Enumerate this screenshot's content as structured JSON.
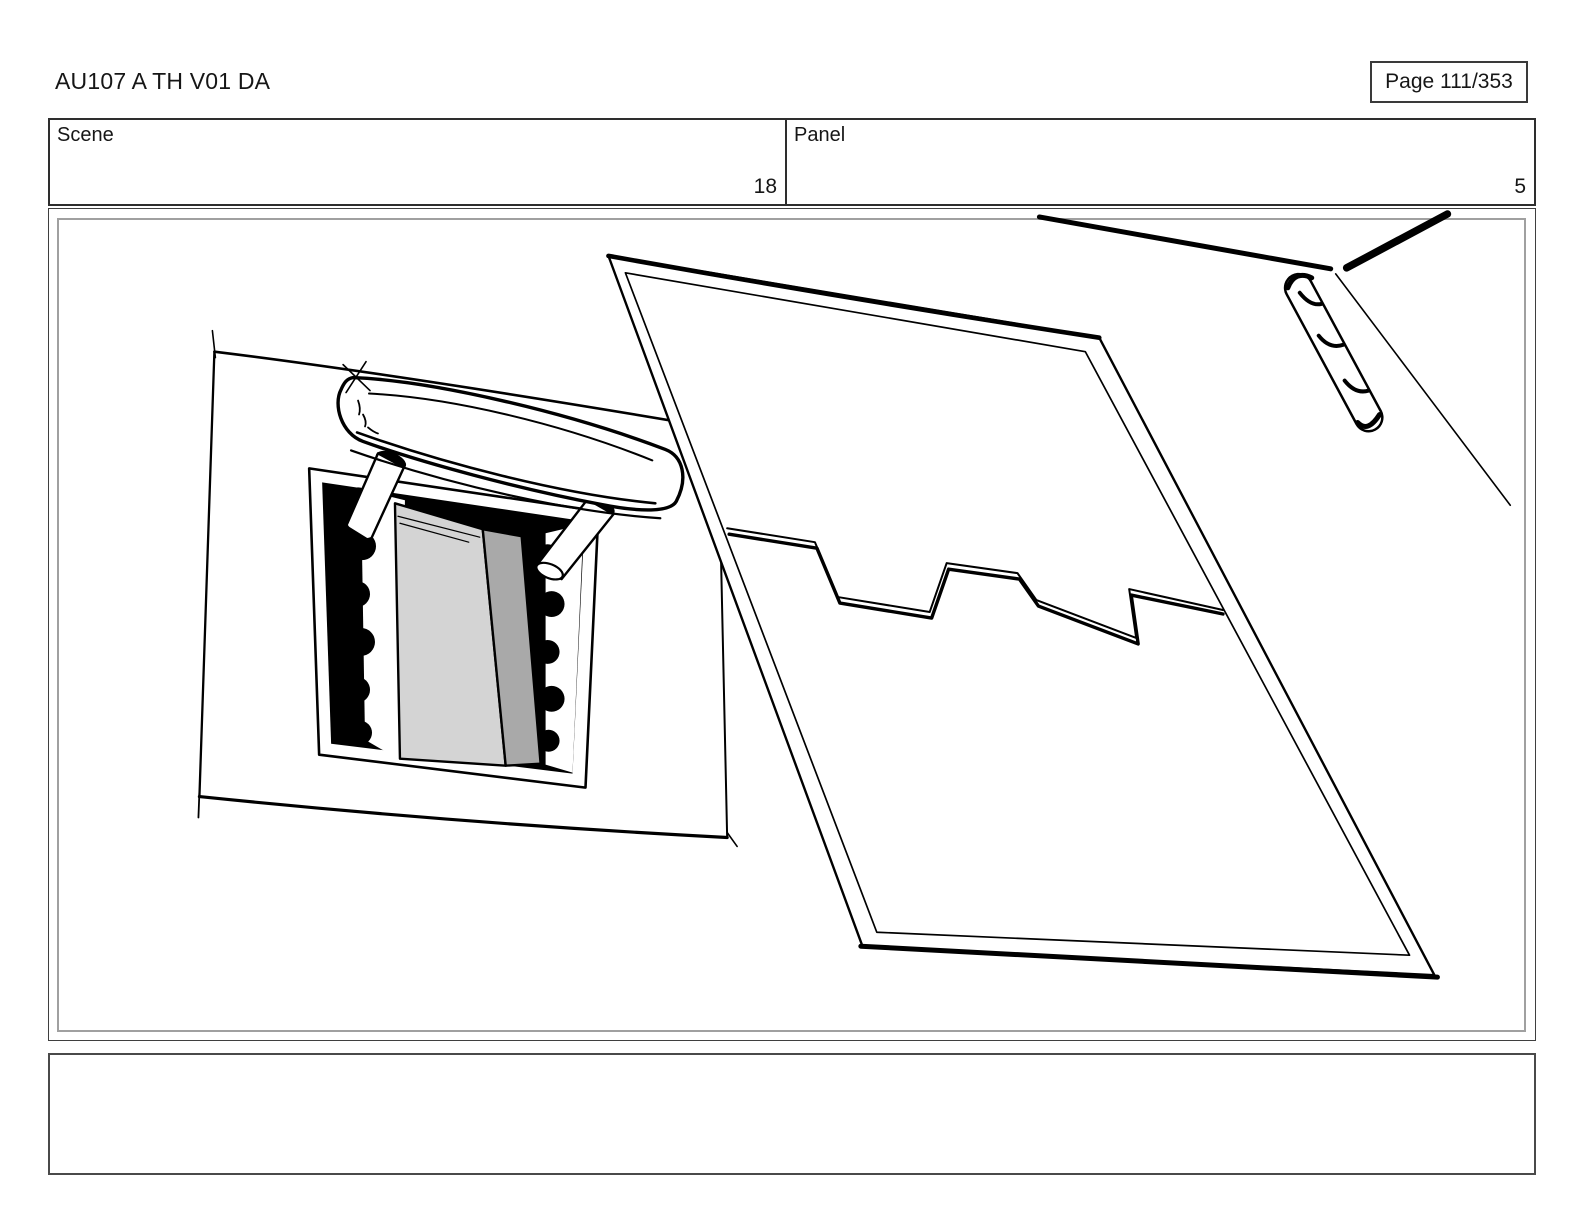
{
  "header": {
    "title": "AU107 A TH V01 DA",
    "page_label": "Page 111/353"
  },
  "info_bar": {
    "scene": {
      "label": "Scene",
      "value": "18"
    },
    "panel": {
      "label": "Panel",
      "value": "5"
    }
  },
  "storyboard": {
    "description": "Hand-drawn black-and-white storyboard sketch: a seat-top panel with an open headrest-post slot and a detached headrest with two posts (left); a large blank seat-back panel with a stepped zigzag cut line across its middle (right); thick corner strokes and a segmented hinge/pen object near the top-right corner.",
    "colors": {
      "ink": "#000000",
      "slot_light_gray": "#d4d4d4",
      "slot_mid_gray": "#a9a9a9",
      "frame_inner_gray": "#a0a0a0",
      "frame_outer": "#3f3f3f"
    }
  },
  "notes": {
    "content": ""
  }
}
